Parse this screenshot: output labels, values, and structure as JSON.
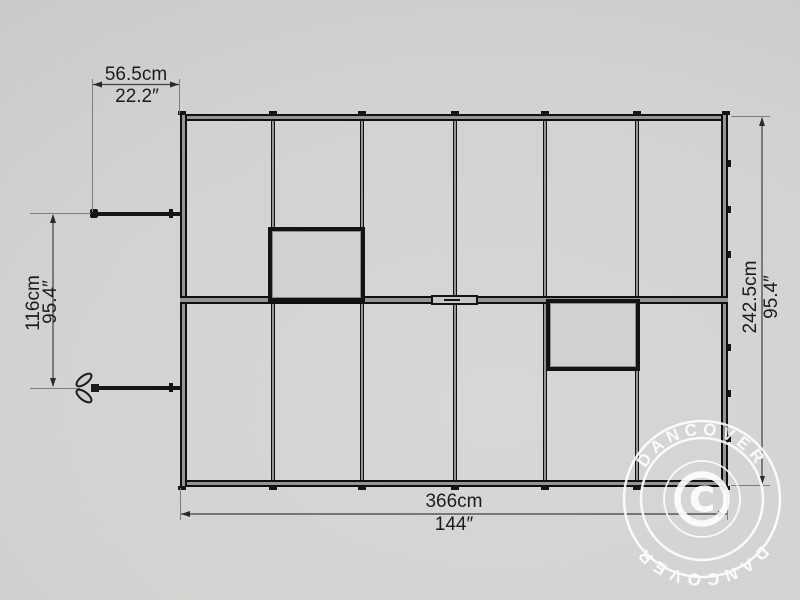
{
  "dimensions": {
    "top": {
      "cm": "56.5cm",
      "inch": "22.2″"
    },
    "left": {
      "cm": "116cm",
      "inch": "95.4″"
    },
    "right": {
      "cm": "242.5cm",
      "inch": "95.4″"
    },
    "bottom": {
      "cm": "366cm",
      "inch": "144″"
    }
  },
  "watermark": {
    "brand_top": "DANCOVER",
    "brand_bottom": "DANCOVER",
    "copyright_letter": "C"
  },
  "colors": {
    "background": "#d2d1d0",
    "frame": "#141414",
    "dimension_text": "#1c1c1c",
    "watermark": "#ffffff"
  }
}
